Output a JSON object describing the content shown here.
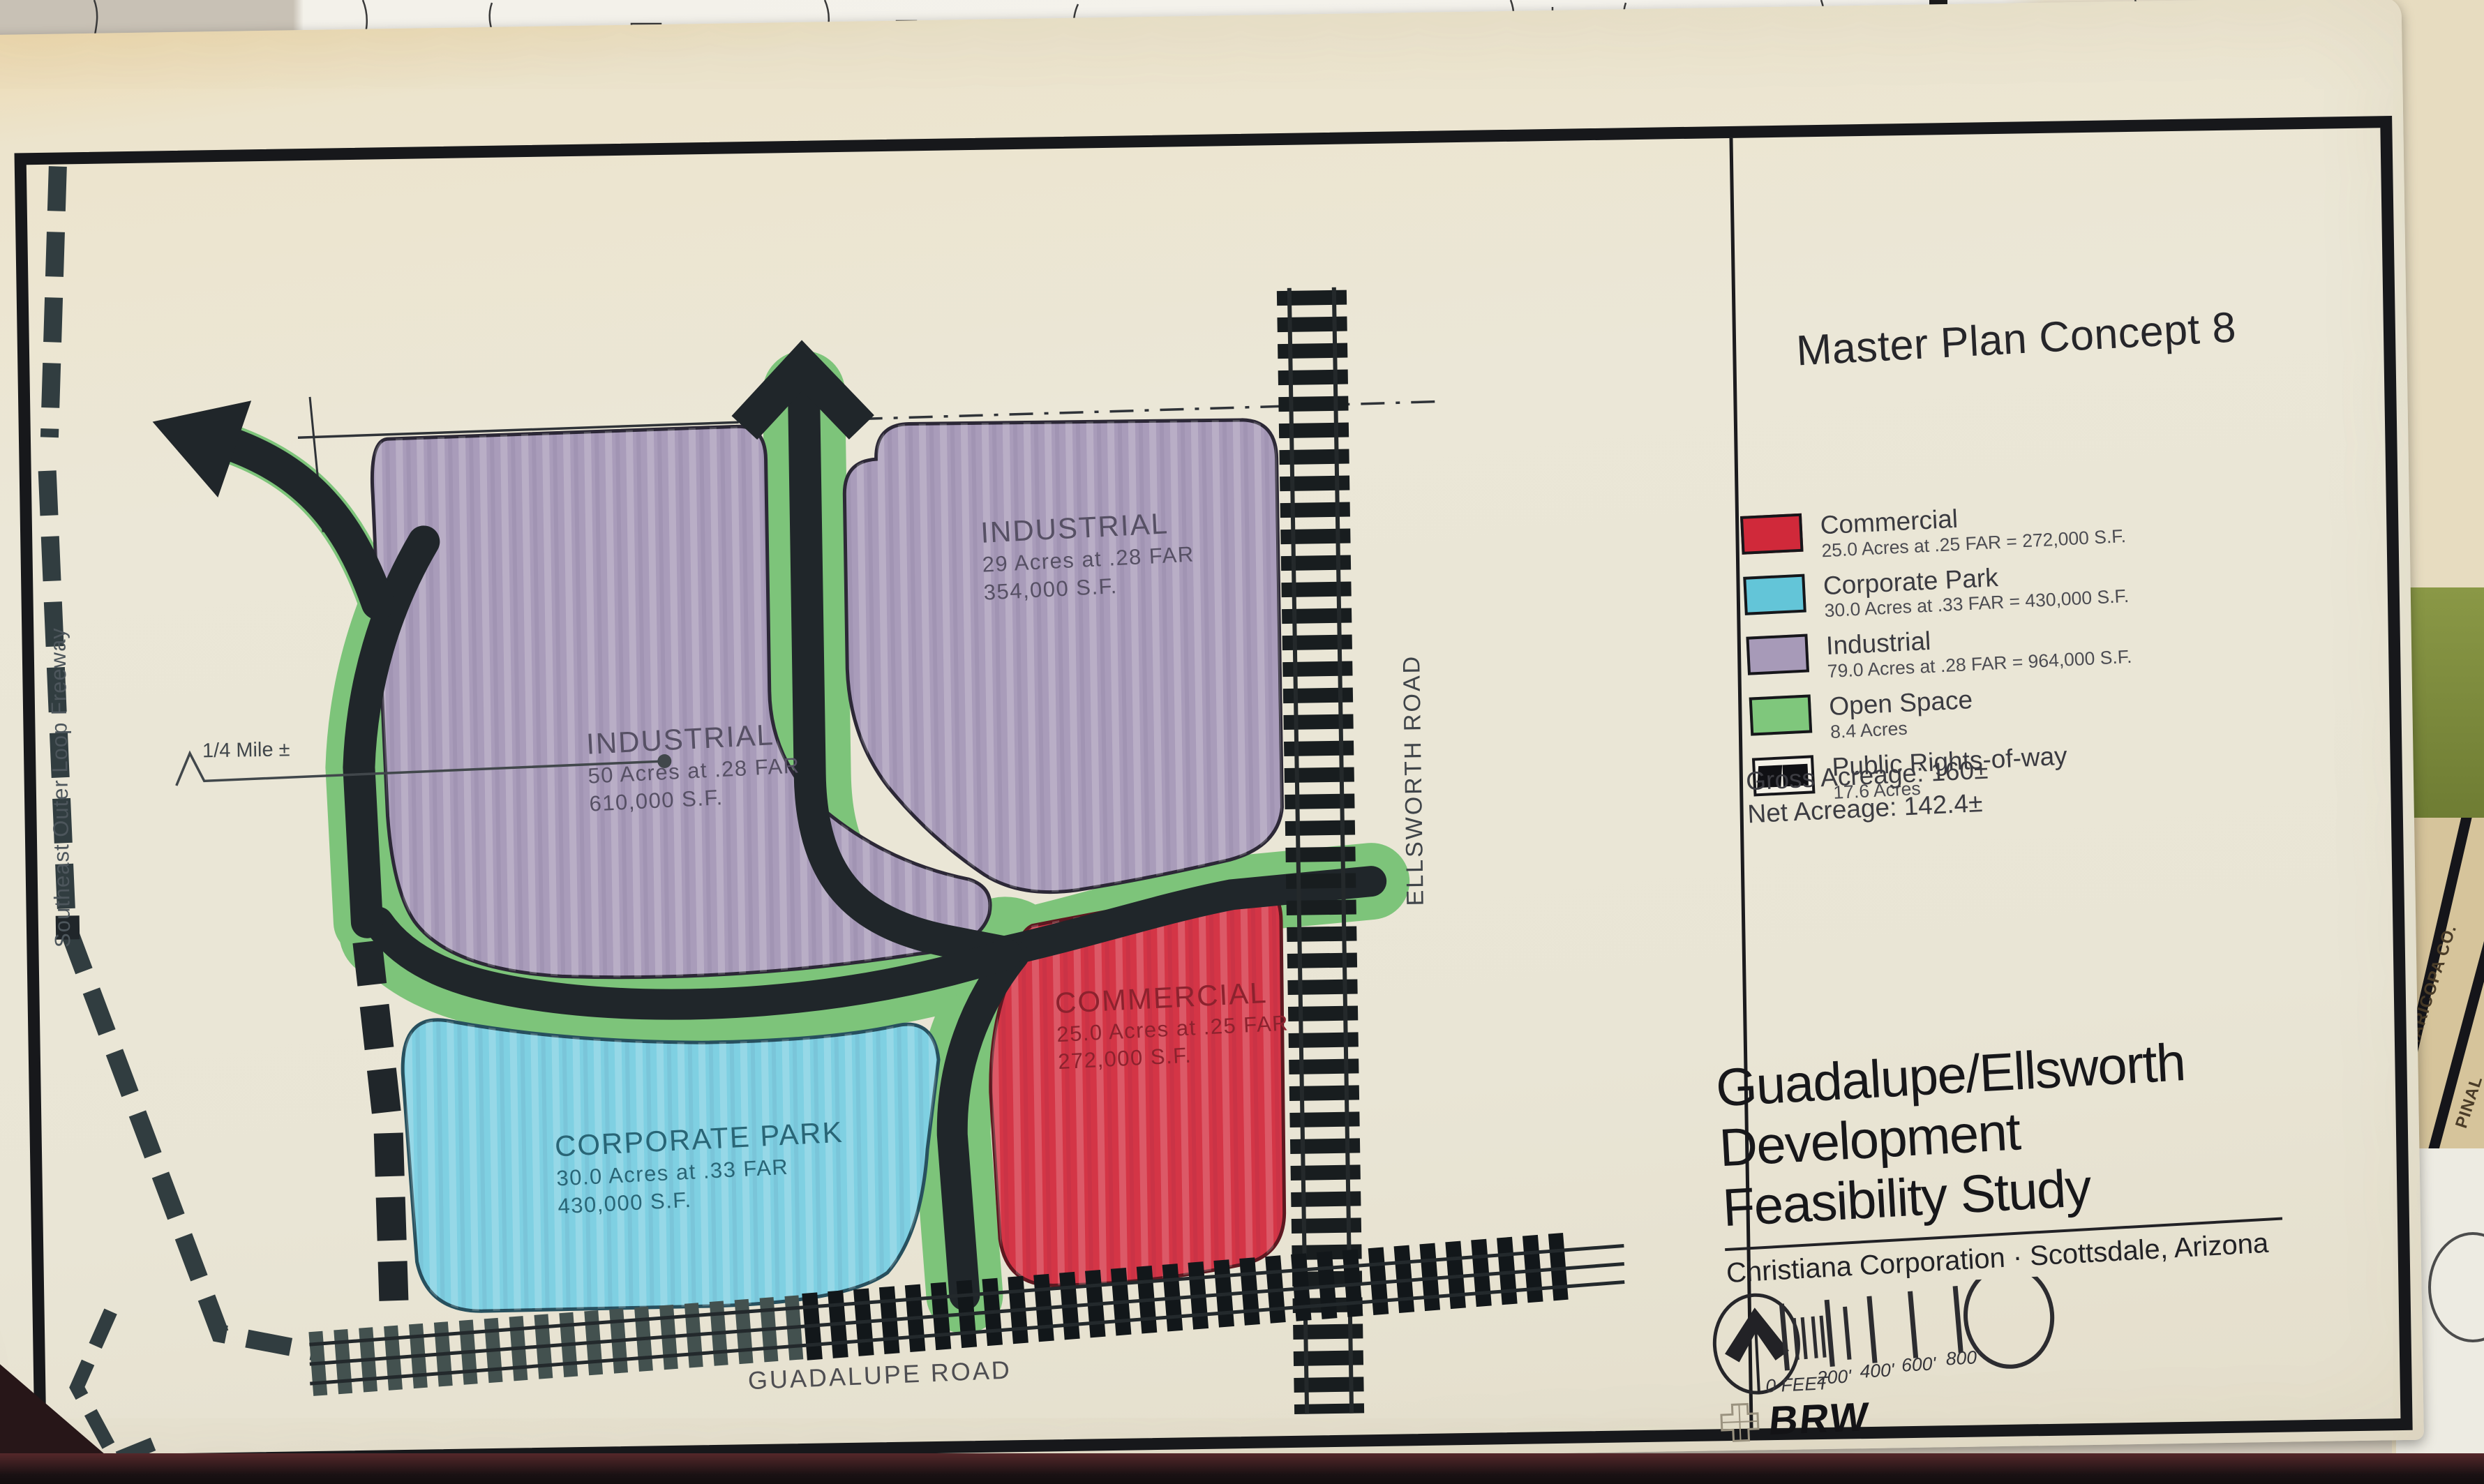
{
  "board": {
    "title": "Master Plan Concept 8",
    "legend": {
      "items": [
        {
          "name": "Commercial",
          "detail": "25.0 Acres at .25 FAR = 272,000 S.F.",
          "color": "#d0293a"
        },
        {
          "name": "Corporate Park",
          "detail": "30.0 Acres at .33 FAR = 430,000 S.F.",
          "color": "#63c5d8"
        },
        {
          "name": "Industrial",
          "detail": "79.0 Acres at .28 FAR = 964,000 S.F.",
          "color": "#a79ab8"
        },
        {
          "name": "Open Space",
          "detail": "8.4 Acres",
          "color": "#7fc77c"
        },
        {
          "name": "Public Rights-of-way",
          "detail": "17.6 Acres",
          "color": "#101014"
        }
      ],
      "gross_acreage": "Gross Acreage: 160±",
      "net_acreage": "Net Acreage: 142.4±"
    },
    "title_block": {
      "line1": "Guadalupe/Ellsworth",
      "line2": "Development",
      "line3": "Feasibility Study",
      "client": "Christiana Corporation · Scottsdale, Arizona"
    },
    "scale_bar": {
      "labels": [
        "0 FEET",
        "200'",
        "400'",
        "600'",
        "800'"
      ]
    },
    "logo": "BRW",
    "map": {
      "zones": [
        {
          "id": "industrial-west",
          "label": "INDUSTRIAL",
          "line2": "50 Acres at .28 FAR",
          "line3": "610,000 S.F.",
          "color": "#a99cba"
        },
        {
          "id": "industrial-east",
          "label": "INDUSTRIAL",
          "line2": "29 Acres at .28 FAR",
          "line3": "354,000 S.F.",
          "color": "#a99cba"
        },
        {
          "id": "commercial",
          "label": "COMMERCIAL",
          "line2": "25.0 Acres at .25 FAR",
          "line3": "272,000 S.F.",
          "color": "#d43546"
        },
        {
          "id": "corporate-park",
          "label": "CORPORATE PARK",
          "line2": "30.0 Acres at .33 FAR",
          "line3": "430,000 S.F.",
          "color": "#7fd0e2"
        }
      ],
      "road_labels": {
        "guadalupe": "GUADALUPE ROAD",
        "ellsworth": "ELLSWORTH ROAD",
        "freeway": "Southeast Outer Loop Freeway",
        "quarter_mile": "1/4 Mile ±"
      },
      "open_space_color": "#7dc47a",
      "road_ink_color": "#20262a"
    },
    "background_labels": {
      "maricopa": "MARICOPA CO.",
      "pinal": "PINAL"
    }
  }
}
